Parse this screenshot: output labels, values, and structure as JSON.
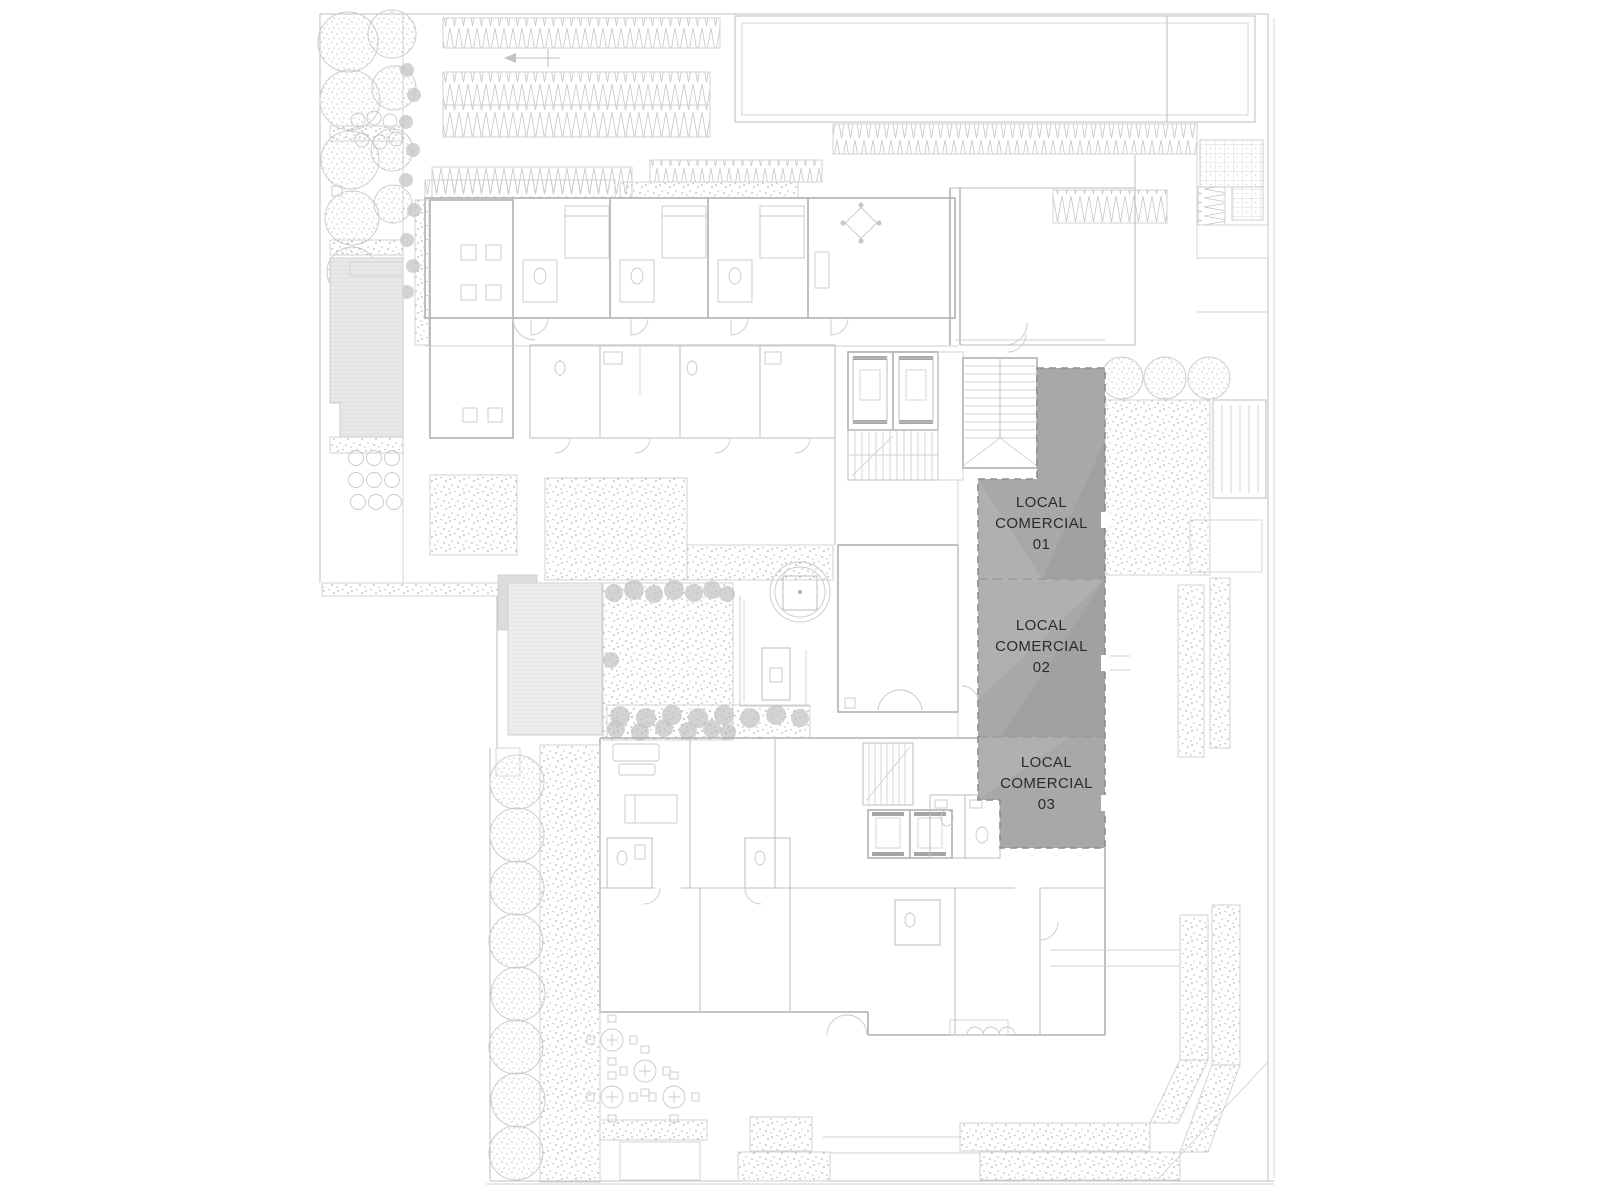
{
  "plan": {
    "units": [
      {
        "id": "local-comercial-01",
        "lines": [
          "LOCAL",
          "COMERCIAL",
          "01"
        ]
      },
      {
        "id": "local-comercial-02",
        "lines": [
          "LOCAL",
          "COMERCIAL",
          "02"
        ]
      },
      {
        "id": "local-comercial-03",
        "lines": [
          "LOCAL",
          "COMERCIAL",
          "03"
        ]
      }
    ],
    "colors": {
      "background": "#ffffff",
      "unit_highlight": "#a8a8a8",
      "unit_border": "#8d8d8d",
      "label_text": "#2b2b2b",
      "wall_line": "#b0b0b0",
      "light_line": "#d2d2d2"
    }
  }
}
